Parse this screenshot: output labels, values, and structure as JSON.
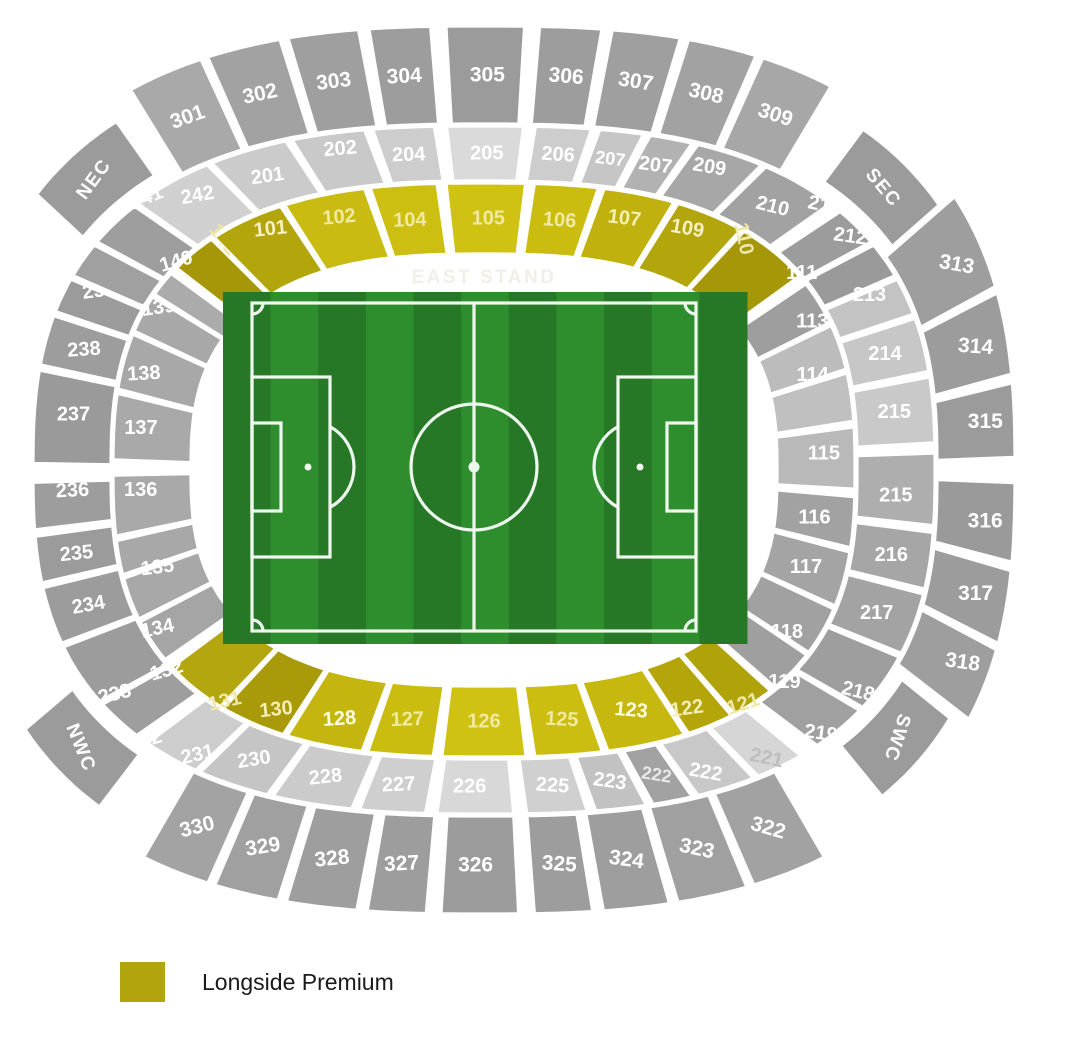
{
  "map": {
    "center": [
      484,
      470
    ],
    "exp": 0.75,
    "stand_label": "EAST STAND",
    "rings": {
      "A": {
        "r0": [
          292,
          215
        ],
        "r1": [
          372,
          288
        ],
        "fs": 20
      },
      "B": {
        "r0": [
          372,
          288
        ],
        "r1": [
          452,
          345
        ],
        "fs": 20
      },
      "C": {
        "r0": [
          452,
          345
        ],
        "r1": [
          532,
          445
        ],
        "fs": 21
      },
      "D": {
        "r0": [
          462,
          356
        ],
        "r1": [
          518,
          424
        ],
        "fs": 19
      }
    },
    "sections": [
      {
        "id": "nec",
        "n": "NEC",
        "g": "D",
        "a0": -56,
        "a1": -39,
        "c": "#9b9b9b",
        "r": -54
      },
      {
        "id": "sec",
        "n": "SEC",
        "g": "D",
        "a0": 41,
        "a1": 58,
        "c": "#9b9b9b",
        "r": 50
      },
      {
        "id": "swc",
        "n": "SWC",
        "g": "D",
        "a0": 119,
        "a1": 135.5,
        "c": "#9b9b9b",
        "r": 108
      },
      {
        "id": "nwc",
        "n": "NWC",
        "g": "D",
        "a0": 222,
        "a1": 239,
        "c": "#9b9b9b",
        "r": 68
      },
      {
        "id": "301",
        "n": "301",
        "g": "C",
        "a0": -36,
        "a1": -25.2,
        "c": "#a9a9a9",
        "r": -20
      },
      {
        "id": "302",
        "n": "302",
        "g": "C",
        "a0": -25.2,
        "a1": -15.8,
        "c": "#a2a2a2",
        "r": -12
      },
      {
        "id": "303",
        "n": "303",
        "g": "C",
        "a0": -15.8,
        "a1": -7.95,
        "c": "#9f9f9f",
        "r": -7
      },
      {
        "id": "304",
        "n": "304",
        "g": "C",
        "a0": -7.95,
        "a1": -2.2,
        "c": "#9d9d9d",
        "r": -3
      },
      {
        "id": "305",
        "n": "305",
        "g": "C",
        "a0": -2.2,
        "a1": 2.35,
        "c": "#9b9b9b",
        "r": 0
      },
      {
        "id": "306",
        "n": "306",
        "g": "C",
        "a0": 2.35,
        "a1": 8.2,
        "c": "#9d9d9d",
        "r": 5
      },
      {
        "id": "307",
        "n": "307",
        "g": "C",
        "a0": 8.2,
        "a1": 15.85,
        "c": "#9f9f9f",
        "r": 9
      },
      {
        "id": "308",
        "n": "308",
        "g": "C",
        "a0": 15.85,
        "a1": 24.65,
        "c": "#a2a2a2",
        "r": 13
      },
      {
        "id": "309",
        "n": "309",
        "g": "C",
        "a0": 24.65,
        "a1": 35,
        "c": "#a7a7a7",
        "r": 18
      },
      {
        "id": "313",
        "n": "313",
        "g": "C",
        "a0": 58,
        "a1": 72.5,
        "c": "#9e9e9e",
        "r": 10,
        "ox": 15
      },
      {
        "id": "314",
        "n": "314",
        "g": "C",
        "a0": 72.5,
        "a1": 83,
        "c": "#9c9c9c",
        "r": 4,
        "ox": 8
      },
      {
        "id": "315",
        "n": "315",
        "g": "C",
        "a0": 83,
        "a1": 90,
        "c": "#9b9b9b",
        "r": 0,
        "ox": 10
      },
      {
        "id": "316",
        "n": "316",
        "g": "C",
        "a0": 90,
        "a1": 97.5,
        "c": "#9a9a9a",
        "r": 0,
        "ox": 10
      },
      {
        "id": "317",
        "n": "317",
        "g": "C",
        "a0": 97.5,
        "a1": 107,
        "c": "#9c9c9c",
        "r": 0,
        "ox": 8
      },
      {
        "id": "318",
        "n": "318",
        "g": "C",
        "a0": 107,
        "a1": 118,
        "c": "#9e9e9e",
        "r": 8,
        "ox": 15
      },
      {
        "id": "322",
        "n": "322",
        "g": "C",
        "a0": 146,
        "a1": 156.5,
        "c": "#a2a2a2",
        "r": 16
      },
      {
        "id": "323",
        "n": "323",
        "g": "C",
        "a0": 156.5,
        "a1": 165.3,
        "c": "#a0a0a0",
        "r": 12
      },
      {
        "id": "324",
        "n": "324",
        "g": "C",
        "a0": 165.3,
        "a1": 172.6,
        "c": "#9e9e9e",
        "r": 8
      },
      {
        "id": "325",
        "n": "325",
        "g": "C",
        "a0": 172.6,
        "a1": 178,
        "c": "#9d9d9d",
        "r": 4
      },
      {
        "id": "326",
        "n": "326",
        "g": "C",
        "a0": 178,
        "a1": 182.5,
        "c": "#9c9c9c",
        "r": 0
      },
      {
        "id": "327",
        "n": "327",
        "g": "C",
        "a0": 182.5,
        "a1": 188.1,
        "c": "#9d9d9d",
        "r": -3
      },
      {
        "id": "328",
        "n": "328",
        "g": "C",
        "a0": 188.1,
        "a1": 196,
        "c": "#9e9e9e",
        "r": -6
      },
      {
        "id": "329",
        "n": "329",
        "g": "C",
        "a0": 196,
        "a1": 204.3,
        "c": "#a0a0a0",
        "r": -9
      },
      {
        "id": "330",
        "n": "330",
        "g": "C",
        "a0": 204.3,
        "a1": 214,
        "c": "#a3a3a3",
        "r": -14
      },
      {
        "id": "242",
        "n": "242",
        "g": "B",
        "a0": -45,
        "a1": -31.05,
        "c": "#d0d0d0",
        "r": -10,
        "oy": -10
      },
      {
        "id": "201",
        "n": "201",
        "g": "B",
        "a0": -31.05,
        "a1": -19.1,
        "c": "#cbcbcb",
        "r": -8
      },
      {
        "id": "202",
        "n": "202",
        "g": "B",
        "a0": -19.1,
        "a1": -9.35,
        "c": "#c9c9c9",
        "r": -5,
        "oy": -12
      },
      {
        "id": "204",
        "n": "204",
        "g": "B",
        "a0": -9.35,
        "a1": -2.55,
        "c": "#cdcdcd",
        "r": -2
      },
      {
        "id": "205",
        "n": "205",
        "g": "B",
        "a0": -2.55,
        "a1": 2.7,
        "c": "#dadada",
        "r": 0
      },
      {
        "id": "206",
        "n": "206",
        "g": "B",
        "a0": 2.7,
        "a1": 8.95,
        "c": "#cdcdcd",
        "r": 4
      },
      {
        "id": "207-left",
        "n": "207",
        "g": "B",
        "a0": 8.95,
        "a1": 14.9,
        "c": "#c6c6c6",
        "r": 7,
        "fs": 18
      },
      {
        "id": "207-right",
        "n": "207",
        "g": "B",
        "a0": 14.9,
        "a1": 21.3,
        "c": "#b2b2b2",
        "r": 8,
        "fs": 20
      },
      {
        "id": "209",
        "n": "209",
        "g": "B",
        "a0": 21.3,
        "a1": 31.9,
        "c": "#a7a7a7",
        "r": 10,
        "oy": -12
      },
      {
        "id": "210",
        "n": "210",
        "g": "B",
        "a0": 31.9,
        "a1": 45,
        "c": "#a2a2a2",
        "r": 14
      },
      {
        "id": "211",
        "n": "211",
        "g": "B",
        "a0": 46.5,
        "a1": 55,
        "c": "#9c9c9c",
        "r": 12,
        "oy": -40
      },
      {
        "id": "212",
        "n": "212",
        "g": "B",
        "a0": 55,
        "a1": 62.5,
        "c": "#9a9a9a",
        "r": 8,
        "oy": -40
      },
      {
        "id": "213",
        "n": "213",
        "g": "B",
        "a0": 62.5,
        "a1": 70,
        "c": "#c3c3c3",
        "r": 0,
        "oy": -15
      },
      {
        "id": "214",
        "n": "214",
        "g": "B",
        "a0": 70,
        "a1": 79.5,
        "c": "#c7c7c7",
        "r": 0
      },
      {
        "id": "215-upper",
        "n": "215",
        "g": "B",
        "a0": 79.5,
        "a1": 88.5,
        "c": "#c9c9c9",
        "r": 0
      },
      {
        "id": "215-lower",
        "n": "215",
        "g": "B",
        "a0": 88.5,
        "a1": 95.5,
        "c": "#aeaeae",
        "r": 0
      },
      {
        "id": "216",
        "n": "216",
        "g": "B",
        "a0": 95.5,
        "a1": 104.5,
        "c": "#a6a6a6",
        "r": 0
      },
      {
        "id": "217",
        "n": "217",
        "g": "B",
        "a0": 104.5,
        "a1": 116,
        "c": "#a3a3a3",
        "r": 0
      },
      {
        "id": "218",
        "n": "218",
        "g": "B",
        "a0": 116,
        "a1": 128,
        "c": "#9e9e9e",
        "r": 14,
        "ox": 10,
        "oy": 25
      },
      {
        "id": "219",
        "n": "219",
        "g": "B",
        "a0": 128,
        "a1": 138.5,
        "c": "#a0a0a0",
        "r": 8,
        "ox": 12,
        "oy": 25
      },
      {
        "id": "221",
        "n": "221",
        "g": "B",
        "a0": 141,
        "a1": 149.4,
        "c": "#d6d6d6",
        "r": 12,
        "t": "#bdbdbd",
        "ox": 12,
        "oy": 15
      },
      {
        "id": "222-right",
        "n": "222",
        "g": "B",
        "a0": 149.4,
        "a1": 158.7,
        "c": "#c8c8c8",
        "r": 10,
        "fs": 20,
        "oy": 10
      },
      {
        "id": "222-left",
        "n": "222",
        "g": "B",
        "a0": 158.7,
        "a1": 164.75,
        "c": "#a2a2a2",
        "r": 9,
        "t": "#e8e8e8",
        "fs": 18
      },
      {
        "id": "223",
        "n": "223",
        "g": "B",
        "a0": 164.75,
        "a1": 171.5,
        "c": "#c2c2c2",
        "r": 8
      },
      {
        "id": "225",
        "n": "225",
        "g": "B",
        "a0": 171.5,
        "a1": 178,
        "c": "#d0d0d0",
        "r": 4
      },
      {
        "id": "226",
        "n": "226",
        "g": "B",
        "a0": 178,
        "a1": 183.3,
        "c": "#d8d8d8",
        "r": 0
      },
      {
        "id": "227",
        "n": "227",
        "g": "B",
        "a0": 183.3,
        "a1": 190.8,
        "c": "#cfcfcf",
        "r": -3
      },
      {
        "id": "228",
        "n": "228",
        "g": "B",
        "a0": 190.8,
        "a1": 201.7,
        "c": "#cbcbcb",
        "r": -6
      },
      {
        "id": "230",
        "n": "230",
        "g": "B",
        "a0": 201.7,
        "a1": 213,
        "c": "#c5c5c5",
        "r": -9
      },
      {
        "id": "231",
        "n": "231",
        "g": "B",
        "a0": 213,
        "a1": 223,
        "c": "#cdcdcd",
        "r": -13,
        "oy": 20
      },
      {
        "id": "232",
        "n": "232",
        "g": "B",
        "a0": 224.5,
        "a1": 233.5,
        "c": "#9e9e9e",
        "r": -16,
        "ox": -5,
        "oy": 40
      },
      {
        "id": "233",
        "n": "233",
        "g": "B",
        "a0": 233.5,
        "a1": 246,
        "c": "#9c9c9c",
        "r": -14,
        "oy": 35
      },
      {
        "id": "234",
        "n": "234",
        "g": "B",
        "a0": 246,
        "a1": 256.5,
        "c": "#9c9c9c",
        "r": -10
      },
      {
        "id": "235",
        "n": "235",
        "g": "B",
        "a0": 256.5,
        "a1": 264,
        "c": "#9b9b9b",
        "r": -6
      },
      {
        "id": "236",
        "n": "236",
        "g": "B",
        "a0": 264,
        "a1": 269.8,
        "c": "#9d9d9d",
        "r": -3,
        "oy": -15
      },
      {
        "id": "237",
        "n": "237",
        "g": "B",
        "a0": 269.8,
        "a1": 281.5,
        "c": "#9a9a9a",
        "r": 0
      },
      {
        "id": "238",
        "n": "238",
        "g": "B",
        "a0": 281.5,
        "a1": 290.5,
        "c": "#9d9d9d",
        "r": -4
      },
      {
        "id": "239",
        "n": "239",
        "g": "B",
        "a0": 290.5,
        "a1": 297.5,
        "c": "#9b9b9b",
        "r": -8,
        "oy": -18
      },
      {
        "id": "240",
        "n": "240",
        "g": "B",
        "a0": 297.5,
        "a1": 305,
        "c": "#a0a0a0",
        "r": -14,
        "ox": -10,
        "oy": -40
      },
      {
        "id": "241",
        "n": "241",
        "g": "B",
        "a0": 305,
        "a1": 315,
        "c": "#9e9e9e",
        "r": -22,
        "oy": -45
      },
      {
        "id": "142",
        "n": "142",
        "g": "A",
        "a0": -51.5,
        "a1": -41.2,
        "c": "#a59708",
        "r": 52,
        "t": "#eee8a8",
        "oy": -40
      },
      {
        "id": "101",
        "n": "101",
        "g": "A",
        "a0": -41.2,
        "a1": -26.3,
        "c": "#b3a50c",
        "r": -6,
        "t": "#f6f2c4",
        "oy": -22
      },
      {
        "id": "102",
        "n": "102",
        "g": "A",
        "a0": -26.3,
        "a1": -12.35,
        "c": "#c9bb11",
        "r": -5,
        "t": "#f0e9a0",
        "oy": -12
      },
      {
        "id": "104",
        "n": "104",
        "g": "A",
        "a0": -12.35,
        "a1": -3.2,
        "c": "#cdbf11",
        "r": -2,
        "t": "#f0e9a0"
      },
      {
        "id": "105",
        "n": "105",
        "g": "A",
        "a0": -3.2,
        "a1": 3.55,
        "c": "#cfc212",
        "r": 0,
        "t": "#f0e9a0"
      },
      {
        "id": "106",
        "n": "106",
        "g": "A",
        "a0": 3.55,
        "a1": 12.45,
        "c": "#cbbd10",
        "r": 4,
        "t": "#f0e9a0"
      },
      {
        "id": "107",
        "n": "107",
        "g": "A",
        "a0": 12.45,
        "a1": 24.55,
        "c": "#c0b10e",
        "r": 7,
        "t": "#f4efb4",
        "oy": -10
      },
      {
        "id": "109",
        "n": "109",
        "g": "A",
        "a0": 24.55,
        "a1": 38.15,
        "c": "#b3a50c",
        "r": 10,
        "t": "#f6f2c4",
        "oy": -18
      },
      {
        "id": "110",
        "n": "110",
        "g": "A",
        "a0": 38.15,
        "a1": 54,
        "c": "#a59708",
        "r": 78,
        "t": "#eee8a8",
        "oy": -40
      },
      {
        "id": "111",
        "n": "111",
        "g": "A",
        "a0": 55.5,
        "a1": 66,
        "c": "#9e9e9e",
        "r": 0,
        "ox": 18,
        "oy": -50
      },
      {
        "id": "113",
        "n": "113",
        "g": "A",
        "a0": 66,
        "a1": 76,
        "c": "#bcbcbc",
        "r": 0,
        "ox": 10,
        "oy": -40
      },
      {
        "id": "114",
        "n": "114",
        "g": "A",
        "a0": 76,
        "a1": 85,
        "c": "#c0c0c0",
        "r": 0,
        "oy": -30
      },
      {
        "id": "115",
        "n": "115",
        "g": "A",
        "a0": 85,
        "a1": 92,
        "c": "#b9b9b9",
        "r": 0,
        "ox": 8
      },
      {
        "id": "116",
        "n": "116",
        "g": "A",
        "a0": 92,
        "a1": 100.5,
        "c": "#a2a2a2",
        "r": 0
      },
      {
        "id": "117",
        "n": "117",
        "g": "A",
        "a0": 100.5,
        "a1": 112,
        "c": "#a4a4a4",
        "r": 0
      },
      {
        "id": "118",
        "n": "118",
        "g": "A",
        "a0": 112,
        "a1": 123.5,
        "c": "#a1a1a1",
        "r": 0,
        "oy": 20
      },
      {
        "id": "119",
        "n": "119",
        "g": "A",
        "a0": 123.5,
        "a1": 134,
        "c": "#9f9f9f",
        "r": 0,
        "ox": 25,
        "oy": 35
      },
      {
        "id": "121",
        "n": "121",
        "g": "A",
        "a0": 134.5,
        "a1": 144,
        "c": "#b0a309",
        "r": -18,
        "t": "#eee8a8",
        "ox": 18,
        "oy": 30
      },
      {
        "id": "122",
        "n": "122",
        "g": "A",
        "a0": 144,
        "a1": 153.5,
        "c": "#b3a50a",
        "r": -8,
        "t": "#f4efb4",
        "oy": 15
      },
      {
        "id": "123",
        "n": "123",
        "g": "A",
        "a0": 153.5,
        "a1": 167,
        "c": "#c6b80f",
        "r": 5,
        "t": "#fdfbe0"
      },
      {
        "id": "125",
        "n": "125",
        "g": "A",
        "a0": 167,
        "a1": 176.4,
        "c": "#ccbe10",
        "r": 3,
        "t": "#f0e9a0"
      },
      {
        "id": "126",
        "n": "126",
        "g": "A",
        "a0": 176.4,
        "a1": 183.6,
        "c": "#cfc212",
        "r": 0,
        "t": "#f0e9a0"
      },
      {
        "id": "127",
        "n": "127",
        "g": "A",
        "a0": 183.6,
        "a1": 192.7,
        "c": "#cbbd10",
        "r": -2,
        "t": "#f0e9a0"
      },
      {
        "id": "128",
        "n": "128",
        "g": "A",
        "a0": 192.7,
        "a1": 205.8,
        "c": "#c4b60e",
        "r": -4,
        "t": "#fdfbe0",
        "oy": 8
      },
      {
        "id": "130",
        "n": "130",
        "g": "A",
        "a0": 205.8,
        "a1": 219,
        "c": "#a89a08",
        "r": -6,
        "t": "#f4efb4",
        "oy": 18
      },
      {
        "id": "131",
        "n": "131",
        "g": "A",
        "a0": 219,
        "a1": 233,
        "c": "#b4a60e",
        "r": -13,
        "t": "#eee8a8",
        "oy": 40
      },
      {
        "id": "132",
        "n": "132",
        "g": "A",
        "a0": 234.5,
        "a1": 245,
        "c": "#a5a5a5",
        "r": -16,
        "ox": -20,
        "oy": 50
      },
      {
        "id": "134",
        "n": "134",
        "g": "A",
        "a0": 245,
        "a1": 254.5,
        "c": "#a8a8a8",
        "r": -12,
        "ox": -10,
        "oy": 45
      },
      {
        "id": "135",
        "n": "135",
        "g": "A",
        "a0": 254.5,
        "a1": 261.5,
        "c": "#a8a8a8",
        "r": -7,
        "oy": 20
      },
      {
        "id": "136",
        "n": "136",
        "g": "A",
        "a0": 261.5,
        "a1": 270.2,
        "c": "#a9a9a9",
        "r": 0,
        "ox": -12,
        "oy": -15
      },
      {
        "id": "137",
        "n": "137",
        "g": "A",
        "a0": 270.2,
        "a1": 280.3,
        "c": "#a9a9a9",
        "r": 0,
        "ox": -12
      },
      {
        "id": "138",
        "n": "138",
        "g": "A",
        "a0": 280.3,
        "a1": 292,
        "c": "#a8a8a8",
        "r": -3,
        "ox": -18
      },
      {
        "id": "139",
        "n": "139",
        "g": "A",
        "a0": 292,
        "a1": 301,
        "c": "#a8a8a8",
        "r": -8,
        "ox": -20,
        "oy": -25
      },
      {
        "id": "140",
        "n": "140",
        "g": "A",
        "a0": 301,
        "a1": 307.5,
        "c": "#ababab",
        "r": -16,
        "ox": -20,
        "oy": -45
      }
    ]
  },
  "pitch": {
    "grass_dark": "#267826",
    "grass_light": "#2e8e2e",
    "line_color": "#eef7ee"
  },
  "legend": {
    "swatch_color": "#b2a40d",
    "label": "Longside Premium"
  }
}
